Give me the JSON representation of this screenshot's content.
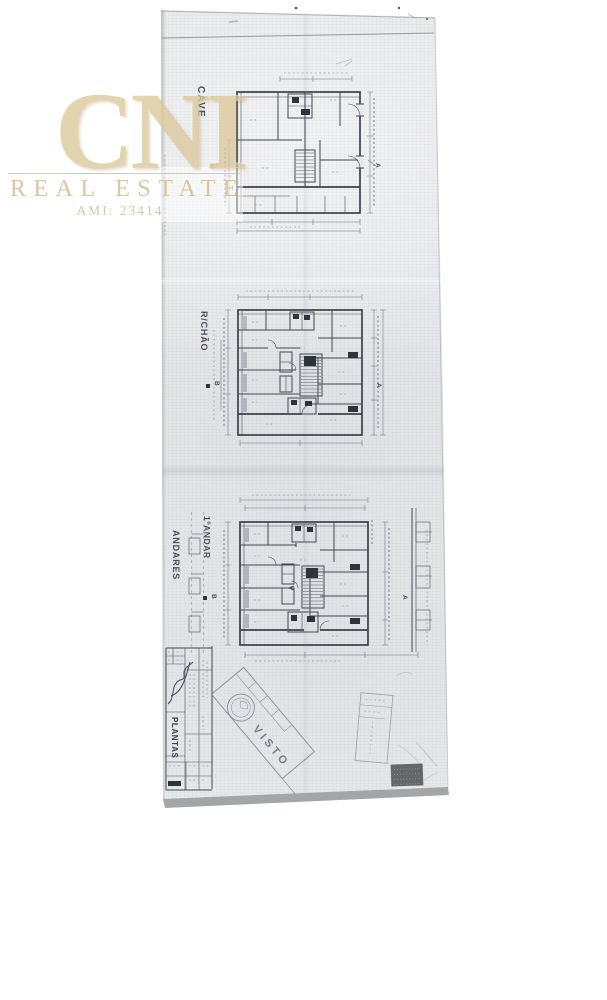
{
  "watermark": {
    "brand": "CNI",
    "registered_mark": "®",
    "tagline": "REAL ESTATE",
    "license": "AMI: 23414",
    "gold_color": "#d6c193"
  },
  "document": {
    "title_block_label": "PLANTAS",
    "approval_stamp": "VISTO",
    "paper_color": "#e7e8ea",
    "ink_color": "#474c54",
    "plans": [
      {
        "id": "cave",
        "label": "CAVE",
        "section_marker_a": "A"
      },
      {
        "id": "r-chao",
        "label": "R/CHÃO",
        "section_marker_a": "A",
        "section_marker_b": "B"
      },
      {
        "id": "andares",
        "label": "ANDARES",
        "label_secondary": "1ºANDAR",
        "section_marker_a": "A",
        "section_marker_b": "B"
      }
    ]
  }
}
